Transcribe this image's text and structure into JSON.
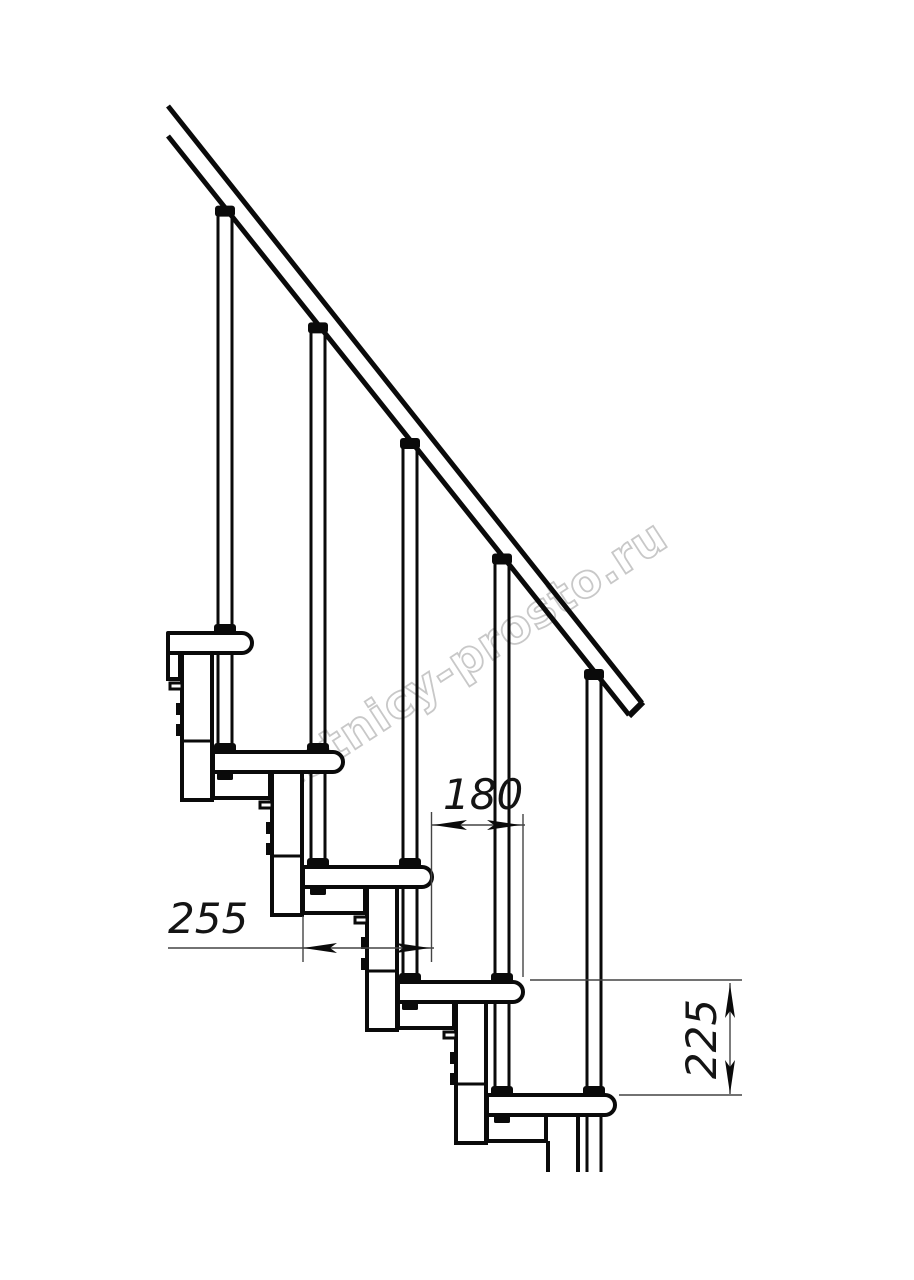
{
  "page": {
    "background": "#ffffff",
    "type": "technical-drawing",
    "subject": "modular staircase side view with step dimensions"
  },
  "watermark": {
    "text": "lestnicy-prosto.ru",
    "color": "#c8c8c8",
    "angle_deg": -33
  },
  "dimensions": {
    "tread_depth": {
      "value": "255",
      "orientation": "horizontal",
      "units": "mm"
    },
    "step_going": {
      "value": "180",
      "orientation": "horizontal",
      "units": "mm"
    },
    "step_rise": {
      "value": "225",
      "orientation": "vertical",
      "units": "mm"
    }
  },
  "diagram": {
    "canvas": {
      "width": 914,
      "height": 1280
    },
    "colors": {
      "line": "#0a0a0a",
      "thin": "#444444",
      "fill": "#ffffff",
      "blob": "#0a0a0a"
    },
    "rail": {
      "upper": {
        "x1": 168,
        "y1": 106,
        "x2": 642,
        "y2": 703
      },
      "lower": {
        "x1": 168,
        "y1": 136,
        "x2": 629,
        "y2": 715
      },
      "cap": {
        "x1": 643,
        "y1": 702,
        "x2": 629,
        "y2": 716
      }
    },
    "tread": {
      "height": 20,
      "nose_radius": 10
    },
    "baluster": {
      "half_width": 7,
      "stroke": 3
    },
    "steps": [
      {
        "left": 168,
        "nose": 252,
        "top": 633,
        "axis": 225
      },
      {
        "left": 213,
        "nose": 343,
        "top": 752,
        "axis": 318
      },
      {
        "left": 303,
        "nose": 432,
        "top": 867,
        "axis": 410
      },
      {
        "left": 398,
        "nose": 523,
        "top": 982,
        "axis": 502
      },
      {
        "left": 487,
        "nose": 615,
        "top": 1095,
        "axis": 594
      }
    ],
    "bottom_cut": {
      "next_left": 579,
      "cut_y": 1172
    },
    "module": {
      "width": 30,
      "below_next_top": 48,
      "divider_above_next_top": 11,
      "tab_offsets": [
        50,
        71
      ],
      "tab_size": [
        7,
        12
      ],
      "tick_offset": 30
    }
  }
}
